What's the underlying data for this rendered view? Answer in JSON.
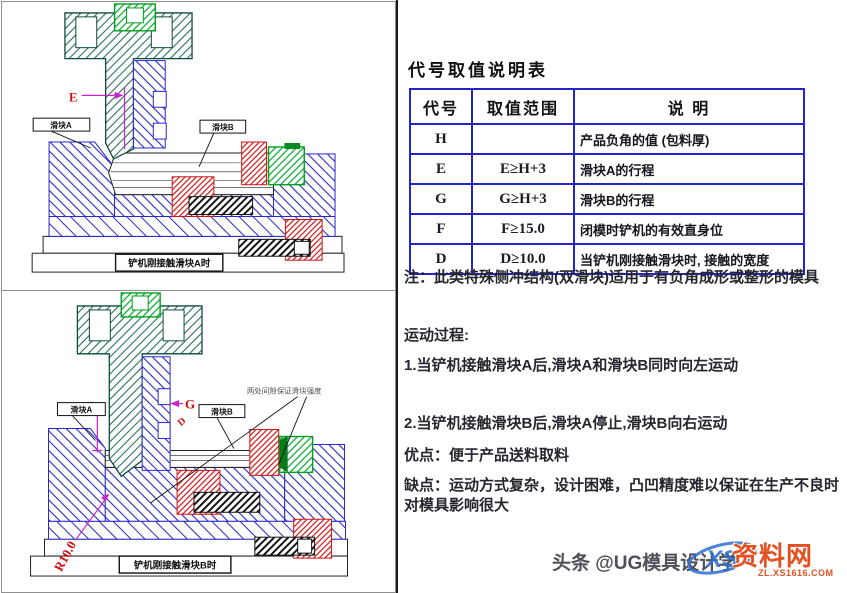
{
  "left_panel": {
    "top_diagram": {
      "caption": "铲机刚接触滑块A时",
      "labels": {
        "slider_a": "滑块A",
        "slider_b": "滑块B",
        "dim_e": "E",
        "dim_d": "D"
      }
    },
    "bottom_diagram": {
      "caption": "铲机刚接触滑块B时",
      "annotation": "两处间隙保证滑块强度",
      "labels": {
        "slider_a": "滑块A",
        "slider_b": "滑块B",
        "dim_f": "F",
        "dim_g": "G",
        "dim_d": "D",
        "radius": "R10.0"
      }
    }
  },
  "right_panel": {
    "table": {
      "title": "代号取值说明表",
      "headers": [
        "代号",
        "取值范围",
        "说  明"
      ],
      "rows": [
        {
          "code": "H",
          "range": "",
          "desc": "产品负角的值 (包料厚)"
        },
        {
          "code": "E",
          "range": "E≥H+3",
          "desc": "滑块A的行程"
        },
        {
          "code": "G",
          "range": "G≥H+3",
          "desc": "滑块B的行程"
        },
        {
          "code": "F",
          "range": "F≥15.0",
          "desc": "闭模时铲机的有效直身位"
        },
        {
          "code": "D",
          "range": "D≥10.0",
          "desc": "当铲机刚接触滑块时, 接触的宽度"
        }
      ]
    },
    "notes": {
      "note": "注：此类特殊侧冲结构(双滑块)适用于有负角成形或整形的模具",
      "motion_title": "运动过程:",
      "step1": "1.当铲机接触滑块A后,滑块A和滑块B同时向左运动",
      "step2": "2.当铲机接触滑块B后,滑块A停止,滑块B向右运动",
      "advantage": "优点：便于产品送料取料",
      "disadvantage": "缺点：运动方式复杂，设计困难，凸凹精度难以保证在生产不良时对模具影响很大"
    },
    "footer": {
      "credit": "头条 @UG模具设计学",
      "watermark_name": "资料网",
      "watermark_url": "ZL.XS1616.COM",
      "watermark_logo_text": "XS"
    }
  },
  "colors": {
    "table_border": "#2424c8",
    "die_blue": "#2828cc",
    "punch_teal": "#2e6e5f",
    "insert_red": "#cc1414",
    "spring_green": "#00a020",
    "dimension_magenta": "#cc22cc",
    "label_red": "#cc1414",
    "watermark_orange": "#e2511f",
    "watermark_blue": "#2e6fd0"
  }
}
